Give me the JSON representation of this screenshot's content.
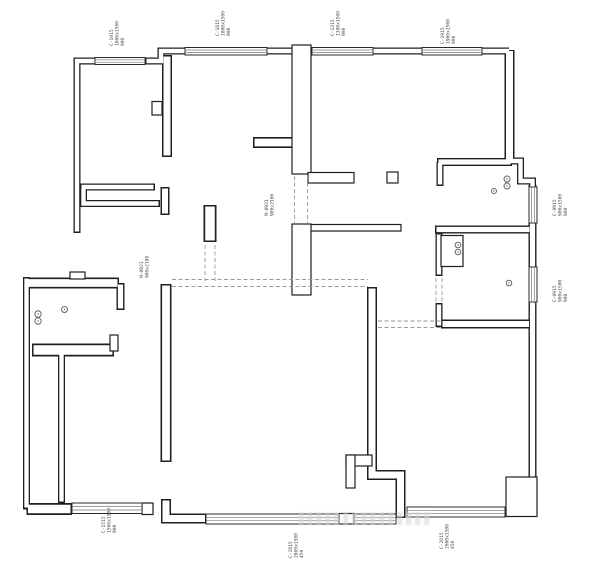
{
  "figure": {
    "type": "floor-plan",
    "background": "#ffffff"
  },
  "colors": {
    "wall_line": "#1f1f1f",
    "window_edge": "#2a2a2a",
    "window_inner": "#787878",
    "dashed_line": "#9a9a9a",
    "fixture_line": "#666666",
    "label_text": "#4a4a4a",
    "watermark": "#d4d4d4"
  },
  "windows": [
    {
      "x": 95,
      "y": 57.5,
      "w": 50,
      "h": 7,
      "o": "h"
    },
    {
      "x": 185,
      "y": 47.5,
      "w": 82,
      "h": 7.5,
      "o": "h"
    },
    {
      "x": 312,
      "y": 47.5,
      "w": 61,
      "h": 7.5,
      "o": "h"
    },
    {
      "x": 422,
      "y": 47.5,
      "w": 60,
      "h": 7.5,
      "o": "h"
    },
    {
      "x": 529,
      "y": 187,
      "w": 8,
      "h": 36,
      "o": "v"
    },
    {
      "x": 529,
      "y": 267,
      "w": 8,
      "h": 35,
      "o": "v"
    },
    {
      "x": 407,
      "y": 507,
      "w": 98,
      "h": 10,
      "o": "h"
    },
    {
      "x": 206,
      "y": 514,
      "w": 133,
      "h": 10,
      "o": "h"
    },
    {
      "x": 354,
      "y": 514,
      "w": 42,
      "h": 10,
      "o": "h"
    },
    {
      "x": 72,
      "y": 503,
      "w": 70,
      "h": 10.5,
      "o": "h"
    }
  ],
  "door_openings": [
    {
      "x1": 172,
      "y1": 279.5,
      "x2": 368,
      "y2": 279.5
    },
    {
      "x1": 172,
      "y1": 286.5,
      "x2": 368,
      "y2": 286.5
    },
    {
      "x1": 294.5,
      "y1": 176,
      "x2": 294.5,
      "y2": 223
    },
    {
      "x1": 307.5,
      "y1": 176,
      "x2": 307.5,
      "y2": 223
    },
    {
      "x1": 205,
      "y1": 245,
      "x2": 205,
      "y2": 281
    },
    {
      "x1": 215,
      "y1": 245,
      "x2": 215,
      "y2": 281
    },
    {
      "x1": 378,
      "y1": 321,
      "x2": 441,
      "y2": 321
    },
    {
      "x1": 378,
      "y1": 327.5,
      "x2": 441,
      "y2": 327.5
    },
    {
      "x1": 436,
      "y1": 278,
      "x2": 436,
      "y2": 303
    },
    {
      "x1": 442,
      "y1": 278,
      "x2": 442,
      "y2": 303
    }
  ],
  "fixtures": [
    {
      "cx": 507,
      "cy": 179,
      "r": 3
    },
    {
      "cx": 507,
      "cy": 186,
      "r": 3
    },
    {
      "cx": 494,
      "cy": 191,
      "r": 2.5
    },
    {
      "cx": 458,
      "cy": 245,
      "r": 2.8
    },
    {
      "cx": 458,
      "cy": 252,
      "r": 2.8
    },
    {
      "cx": 509,
      "cy": 283,
      "r": 2.8
    },
    {
      "cx": 38,
      "cy": 314,
      "r": 3.2
    },
    {
      "cx": 38,
      "cy": 321,
      "r": 3.2
    },
    {
      "cx": 64.5,
      "cy": 309.5,
      "r": 3
    }
  ],
  "labels": [
    {
      "x": 113,
      "y": 46,
      "lines": [
        "C-1015",
        "1000x1500",
        "900"
      ]
    },
    {
      "x": 219,
      "y": 36,
      "lines": [
        "C-1815",
        "1800x1500",
        "900"
      ]
    },
    {
      "x": 334,
      "y": 36,
      "lines": [
        "C-1315",
        "1300x1500",
        "900"
      ]
    },
    {
      "x": 444,
      "y": 44,
      "lines": [
        "C-1915",
        "1900x1500",
        "900"
      ]
    },
    {
      "x": 556,
      "y": 216,
      "lines": [
        "C-0915",
        "900x1500",
        "900"
      ]
    },
    {
      "x": 556,
      "y": 302,
      "lines": [
        "C-0915",
        "900x1500",
        "900"
      ]
    },
    {
      "x": 143,
      "y": 278,
      "lines": [
        "M-0921",
        "900x2100"
      ]
    },
    {
      "x": 268,
      "y": 216,
      "lines": [
        "M-0921",
        "900x2100"
      ]
    },
    {
      "x": 292,
      "y": 558,
      "lines": [
        "C-2815",
        "2800x1500",
        "450"
      ]
    },
    {
      "x": 443,
      "y": 549,
      "lines": [
        "C-2015",
        "2000x1500",
        "450"
      ]
    },
    {
      "x": 105,
      "y": 533,
      "lines": [
        "C-1515",
        "1500x1500",
        "900"
      ]
    }
  ]
}
